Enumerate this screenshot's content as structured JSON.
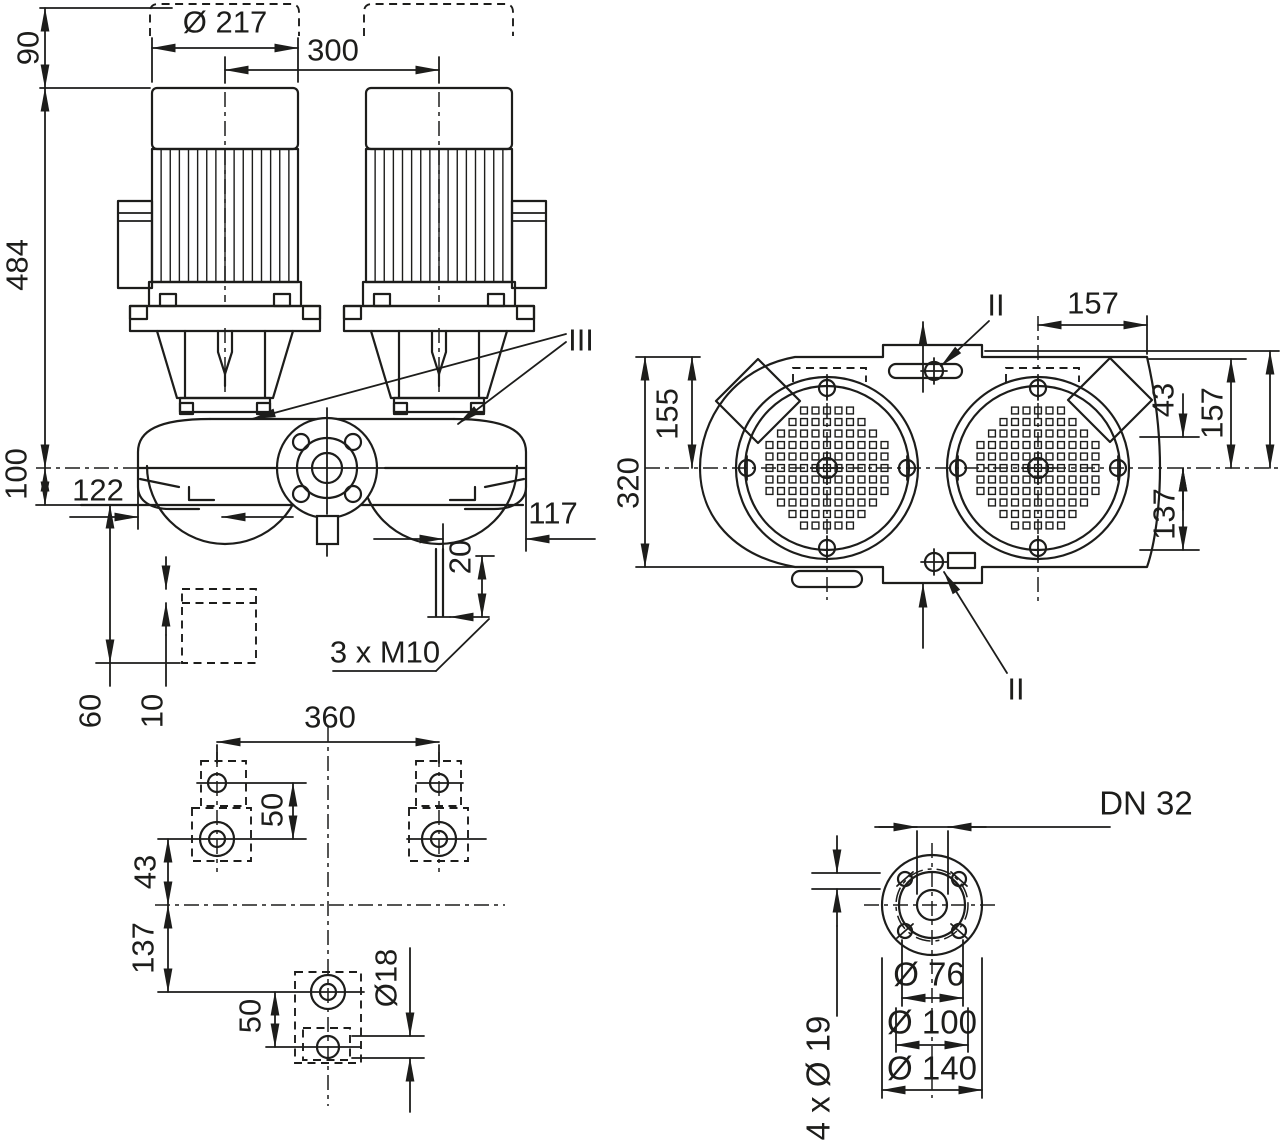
{
  "colors": {
    "line": "#1d1d1b",
    "background": "#ffffff"
  },
  "front_view": {
    "dim_height_top": "90",
    "dim_height_total": "484",
    "dim_height_base": "100",
    "dim_motor_diameter": "Ø 217",
    "dim_axis_spacing": "300",
    "dim_left_port": "122",
    "dim_right_port": "117",
    "dim_drain_offset": "20",
    "label_tapped_holes": "3 x M10",
    "dim_foundation_depth": "60",
    "dim_foundation_offset": "10",
    "section_mark": "III"
  },
  "top_view": {
    "dim_casing_length": "320",
    "dim_center_to_edge_left": "155",
    "dim_center_to_edge_top": "157",
    "dim_foot_front": "43",
    "dim_center_to_edge_right": "157",
    "dim_foot_rear": "137",
    "section_mark_top": "II",
    "section_mark_bottom": "II"
  },
  "foundation_view": {
    "dim_bolt_spacing": "360",
    "dim_hole_pitch_upper": "50",
    "dim_foot_front": "43",
    "dim_foot_rear": "137",
    "dim_hole_pitch_lower": "50",
    "dim_hole_diameter": "Ø18"
  },
  "flange_view": {
    "label_nominal": "DN 32",
    "dim_face": "Ø 76",
    "dim_bolt_circle": "Ø 100",
    "dim_outer": "Ø 140",
    "label_bolt_holes": "4 x Ø 19"
  }
}
